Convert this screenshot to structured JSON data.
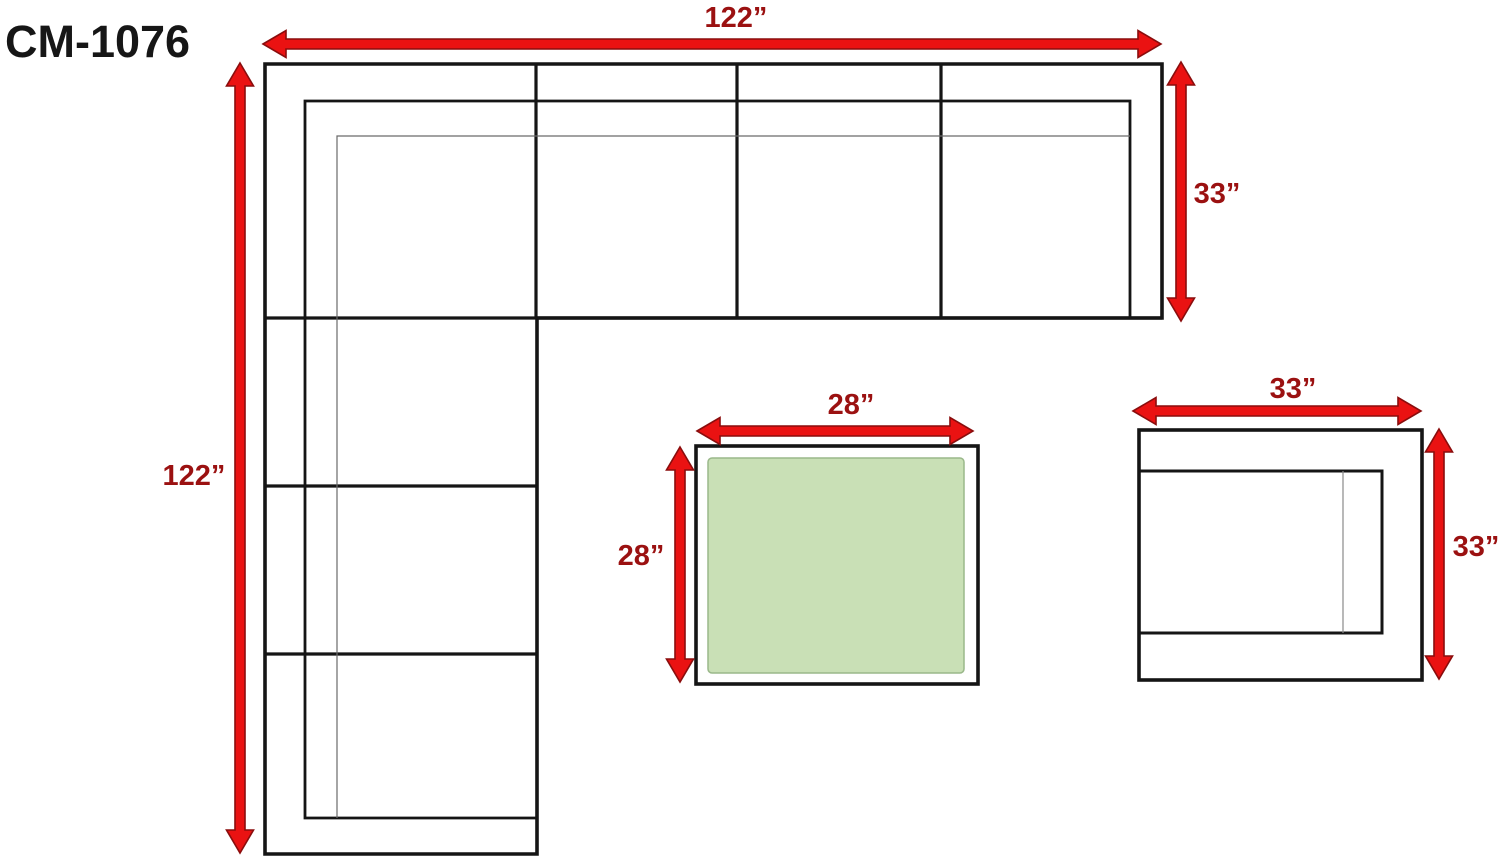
{
  "title": "CM-1076",
  "labels": {
    "sofa_width": "122”",
    "sofa_height": "122”",
    "sofa_depth": "33”",
    "coffee_width": "28”",
    "coffee_depth": "28”",
    "side_width": "33”",
    "side_depth": "33”"
  },
  "dimensions_in": {
    "sectional_width": 122,
    "sectional_length": 122,
    "sectional_depth": 33,
    "coffee_table_width": 28,
    "coffee_table_depth": 28,
    "side_table_width": 33,
    "side_table_depth": 33
  },
  "colors": {
    "arrow_red": "#ea1212",
    "arrow_outline": "#8a0d0d",
    "dimension_text": "#9b1111",
    "outline_black": "#151515",
    "thin_line_gray": "#6a6a6a",
    "table_green_fill": "#c9e0b6",
    "table_green_border": "#9ab88a",
    "background": "#ffffff"
  }
}
